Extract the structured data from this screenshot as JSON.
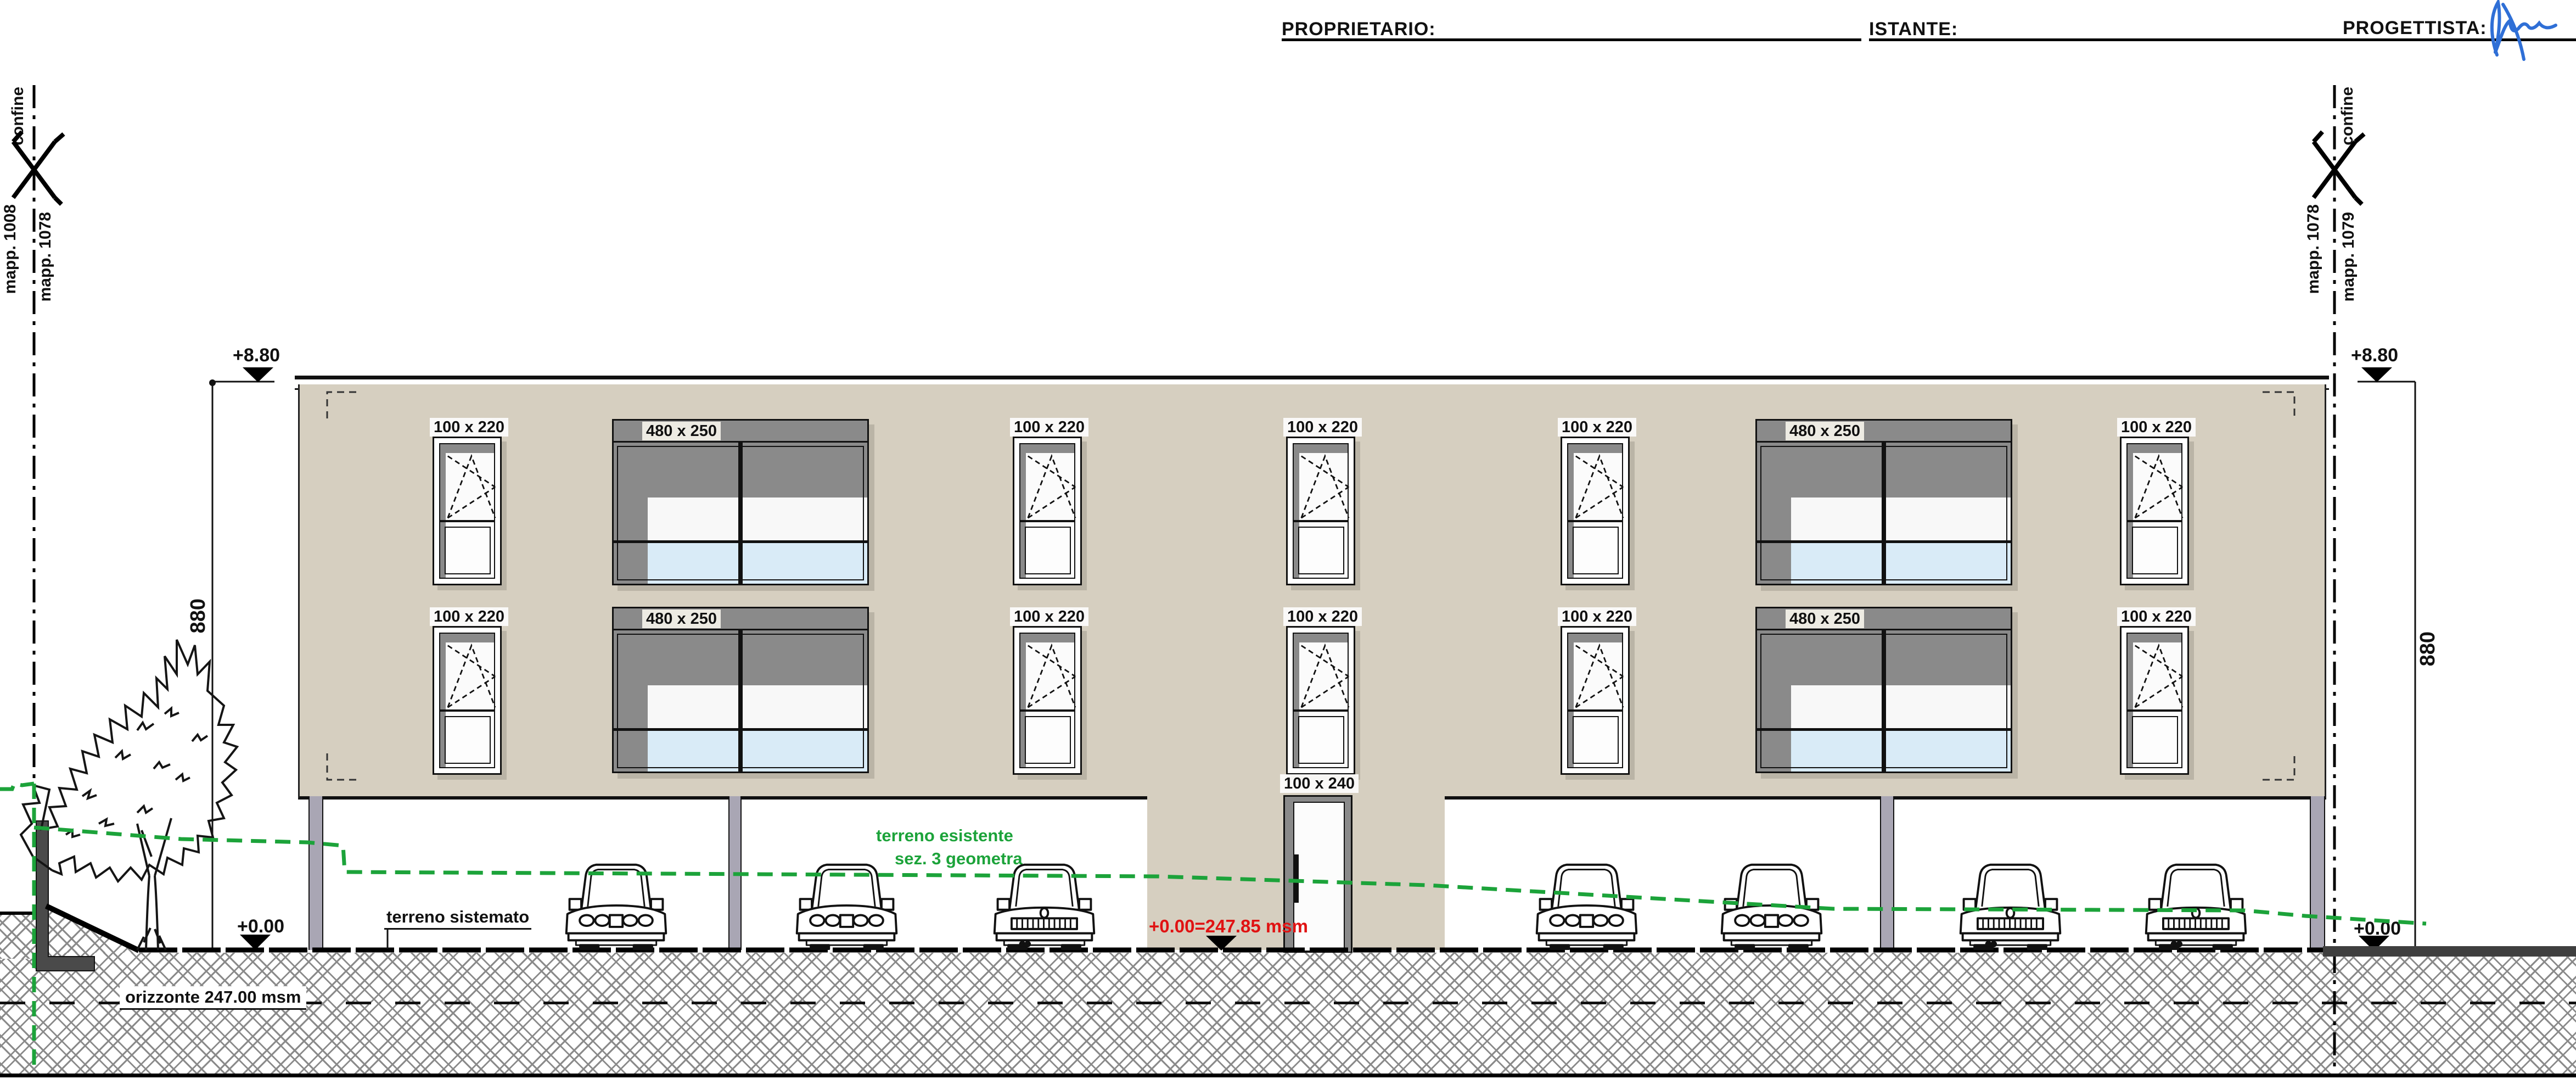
{
  "header": {
    "proprietario": "PROPRIETARIO:",
    "istante": "ISTANTE:",
    "progettista": "PROGETTISTA:"
  },
  "boundary_left": {
    "confine": "confine",
    "mapp_a": "mapp. 1008",
    "mapp_b": "mapp. 1078"
  },
  "boundary_right": {
    "confine": "confine",
    "mapp_a": "mapp. 1078",
    "mapp_b": "mapp. 1079"
  },
  "levels": {
    "roof_left": "+8.80",
    "roof_right": "+8.80",
    "zero_left": "+0.00",
    "zero_right": "+0.00",
    "red_level": "+0.00=247.85 msm",
    "dim_left": "880",
    "dim_right": "880"
  },
  "terrain": {
    "esistente_line1": "terreno esistente",
    "esistente_line2": "sez. 3 geometra",
    "sistemato": "terreno sistemato",
    "orizzonte": "orizzonte 247.00 msm"
  },
  "door": {
    "label": "100 x 240"
  },
  "windows": {
    "row1": [
      {
        "label": "100 x 220"
      },
      {
        "label": "480 x 250"
      },
      {
        "label": "100 x 220"
      },
      {
        "label": "100 x 220"
      },
      {
        "label": "100 x 220"
      },
      {
        "label": "480 x 250"
      },
      {
        "label": "100 x 220"
      }
    ],
    "row2": [
      {
        "label": "100 x 220"
      },
      {
        "label": "480 x 250"
      },
      {
        "label": "100 x 220"
      },
      {
        "label": "100 x 220"
      },
      {
        "label": "100 x 220"
      },
      {
        "label": "480 x 250"
      },
      {
        "label": "100 x 220"
      }
    ]
  },
  "colors": {
    "facade": "#d6cfc0",
    "frame_gray": "#8a8a8a",
    "glass_blue": "#d9ebf7",
    "pilaster": "#a9a6b4",
    "terrain_green": "#1ca33a",
    "level_red": "#e01212",
    "signature_blue": "#2f6fd6",
    "ground_dark": "#3f3f3f"
  }
}
